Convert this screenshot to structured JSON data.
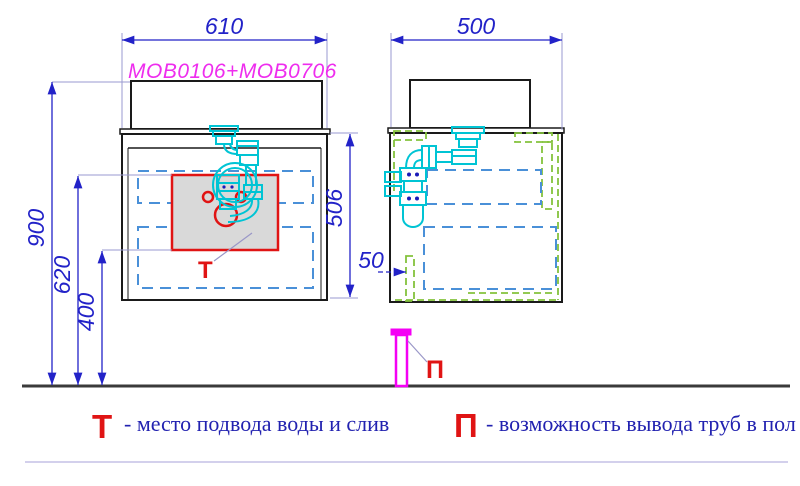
{
  "drawing_title": "MOB0106+MOB0706",
  "dimensions": {
    "front_width": "610",
    "side_depth": "500",
    "total_height": "900",
    "zone_top_height": "620",
    "zone_bottom_height": "400",
    "cabinet_height": "506",
    "back_offset": "50"
  },
  "markers": {
    "water_supply": "Т",
    "floor_outlet": "П"
  },
  "legend": {
    "water": {
      "symbol": "Т",
      "text": "- место подвода воды и слив"
    },
    "floor": {
      "symbol": "П",
      "text": "- возможность вывода труб в пол"
    }
  },
  "colors": {
    "dimension_blue": "#2222c8",
    "drawer_dash_blue": "#4a90d8",
    "fitting_dash_green": "#84c23c",
    "plumbing_cyan": "#00c4d4",
    "pipe_magenta": "#f400f4",
    "marker_red": "#e01414",
    "zone_fill_gray": "#d9d9d9",
    "legend_text_blue": "#2222b0",
    "outline_black": "#1a1a1a"
  }
}
